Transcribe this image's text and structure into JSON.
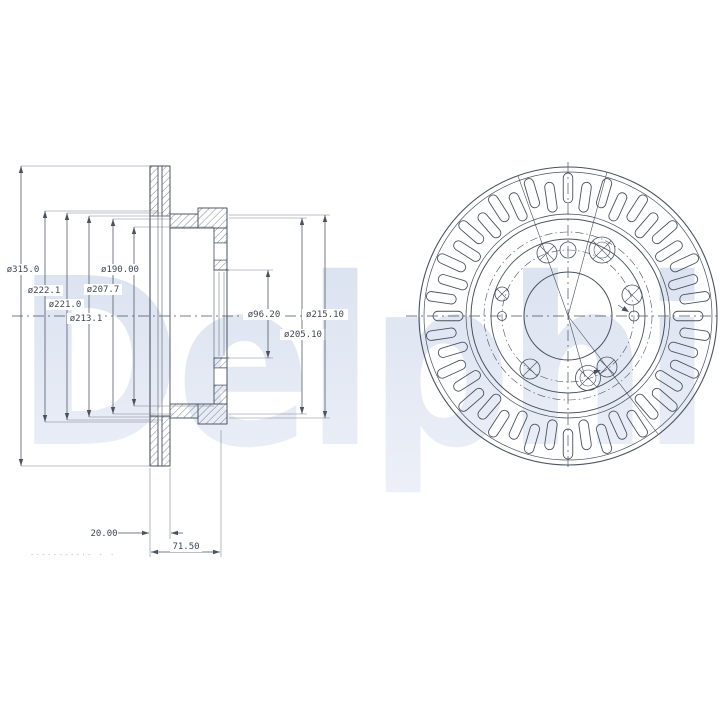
{
  "watermark": {
    "text": "Delphi"
  },
  "section_view": {
    "labels": {
      "d315": "ø315.0",
      "d222": "ø222.1",
      "d221": "ø221.0",
      "d213": "ø213.1",
      "d207": "ø207.7",
      "d190": "ø190.00",
      "d96": "ø96.20",
      "d205": "ø205.10",
      "d215": "ø215.10",
      "w20": "20.00",
      "w71": "71.50"
    }
  },
  "stamp": {
    "marks": "-·-·---·-·-  ·   ·"
  },
  "colors": {
    "line": "#49525f",
    "ext_line": "#7a8290",
    "watermark_top": "#d9e1ef",
    "watermark_bottom": "#edf0f8",
    "stamp": "#b2b5bb"
  }
}
